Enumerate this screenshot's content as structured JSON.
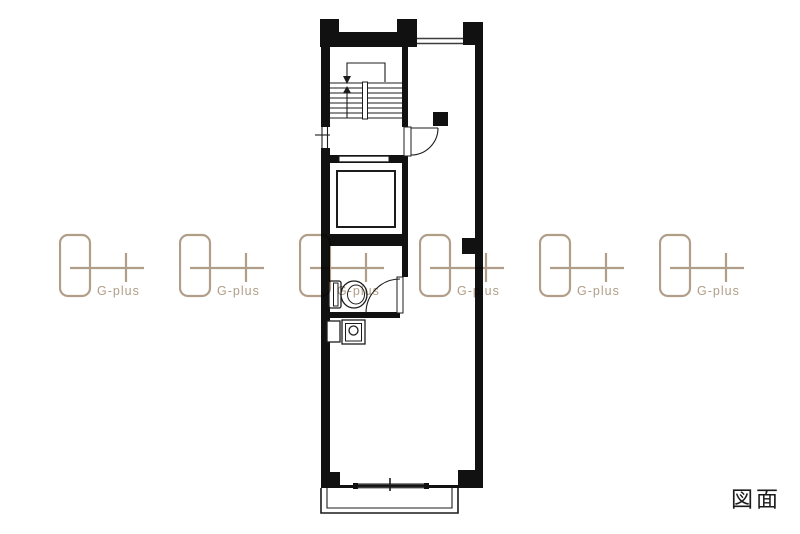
{
  "canvas": {
    "width": 800,
    "height": 534,
    "background": "#ffffff"
  },
  "labels": {
    "drawing": "図面"
  },
  "watermark": {
    "label": "G-plus",
    "color": "#b19e88",
    "count": 6
  },
  "plan": {
    "line_color": "#111111",
    "window_line_color": "#3d3d3d",
    "features": "floor-plan line drawing: stairwell, elevator, wc, sink-counter, main room, balcony"
  }
}
